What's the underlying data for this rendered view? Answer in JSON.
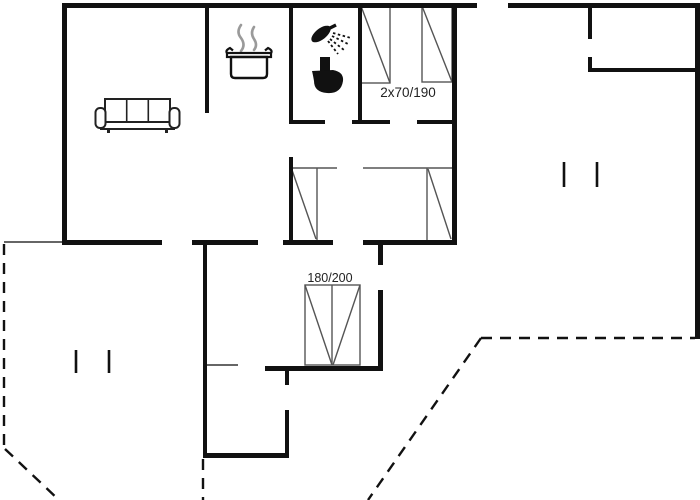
{
  "plan": {
    "title": "holiday-home-floor-plan",
    "colors": {
      "background": "#ffffff",
      "wall": "#111111",
      "thin_line": "#333333",
      "furniture_line": "#555555",
      "steam": "#9a9a9a",
      "text": "#222222"
    },
    "labels": [
      {
        "name": "bed-size-label-top",
        "text": "2x70/190",
        "x": 408,
        "y": 97,
        "size": 13.5
      },
      {
        "name": "bed-size-label-double",
        "text": "180/200",
        "x": 330,
        "y": 282,
        "size": 12.5
      }
    ],
    "walls": [
      {
        "name": "exterior-top-wall-left",
        "rect": [
          62,
          3,
          415,
          5
        ]
      },
      {
        "name": "exterior-top-wall-right",
        "rect": [
          508,
          3,
          192,
          5
        ]
      },
      {
        "name": "exterior-left-wall",
        "rect": [
          62,
          3,
          5,
          242
        ]
      },
      {
        "name": "exterior-right-wall",
        "rect": [
          695,
          3,
          5,
          336
        ]
      },
      {
        "name": "annex-wall-upper",
        "rect": [
          588,
          3,
          4,
          36
        ]
      },
      {
        "name": "annex-wall-lower",
        "rect": [
          588,
          57,
          4,
          15
        ]
      },
      {
        "name": "annex-bottom-wall",
        "rect": [
          588,
          68,
          112,
          4
        ]
      },
      {
        "name": "kitchen-partition-wall",
        "rect": [
          205,
          3,
          4,
          110
        ]
      },
      {
        "name": "bathroom-left-wall",
        "rect": [
          289,
          3,
          4,
          119
        ]
      },
      {
        "name": "bathroom-right-wall",
        "rect": [
          358,
          3,
          4,
          119
        ]
      },
      {
        "name": "bedroom1-right-wall",
        "rect": [
          452,
          3,
          5,
          242
        ]
      },
      {
        "name": "bathroom-bottom-wall",
        "rect": [
          289,
          120,
          36,
          4
        ]
      },
      {
        "name": "bedroom1-bottom-wall-left",
        "rect": [
          352,
          120,
          38,
          4
        ]
      },
      {
        "name": "bedroom1-bottom-wall-right",
        "rect": [
          417,
          120,
          35,
          4
        ]
      },
      {
        "name": "south-wall-a",
        "rect": [
          62,
          240,
          100,
          5
        ]
      },
      {
        "name": "south-wall-b",
        "rect": [
          192,
          240,
          66,
          5
        ]
      },
      {
        "name": "south-wall-c",
        "rect": [
          283,
          240,
          50,
          5
        ]
      },
      {
        "name": "south-wall-d",
        "rect": [
          363,
          240,
          94,
          5
        ]
      },
      {
        "name": "hallway-left-wall",
        "rect": [
          203,
          240,
          4,
          218
        ]
      },
      {
        "name": "bottom-room-bottom-wall",
        "rect": [
          203,
          453,
          86,
          5
        ]
      },
      {
        "name": "bottom-room-right-wall",
        "rect": [
          285,
          410,
          4,
          47
        ]
      },
      {
        "name": "bottom-room-right-stub",
        "rect": [
          285,
          366,
          4,
          19
        ]
      },
      {
        "name": "double-bedroom-bottom-wall",
        "rect": [
          265,
          366,
          118,
          5
        ]
      },
      {
        "name": "double-bedroom-right-wall",
        "rect": [
          378,
          290,
          5,
          80
        ]
      },
      {
        "name": "double-bedroom-right-stub",
        "rect": [
          378,
          245,
          5,
          20
        ]
      },
      {
        "name": "alcove-left-wall",
        "rect": [
          289,
          157,
          4,
          87
        ]
      }
    ],
    "thin_lines": [
      {
        "name": "terrace-edge-line",
        "line": [
          4,
          242,
          62,
          242
        ]
      },
      {
        "name": "closet-front-line",
        "line": [
          205,
          365,
          238,
          365
        ]
      }
    ],
    "dashed_lines": [
      {
        "name": "terrace-boundary-west",
        "line": [
          4,
          244,
          4,
          448
        ]
      },
      {
        "name": "terrace-boundary-southwest-diagonal",
        "line": [
          5,
          449,
          59,
          500
        ]
      },
      {
        "name": "terrace-boundary-south",
        "line": [
          203,
          459,
          203,
          500
        ]
      },
      {
        "name": "terrace-boundary-east-horizontal",
        "line": [
          481,
          338,
          695,
          338
        ]
      },
      {
        "name": "terrace-boundary-east-diagonal",
        "line": [
          481,
          338,
          368,
          500
        ]
      }
    ],
    "window_ticks": [
      {
        "name": "window-tick",
        "line": [
          76,
          350,
          76,
          373
        ]
      },
      {
        "name": "window-tick",
        "line": [
          109,
          350,
          109,
          373
        ]
      },
      {
        "name": "window-tick",
        "line": [
          564,
          162,
          564,
          187
        ]
      },
      {
        "name": "window-tick",
        "line": [
          597,
          162,
          597,
          187
        ]
      }
    ],
    "beds": [
      {
        "name": "single-bed-1",
        "rect": [
          361,
          6,
          29,
          77
        ],
        "lines": [
          [
            361,
            6,
            390,
            83
          ]
        ]
      },
      {
        "name": "single-bed-2",
        "rect": [
          422,
          6,
          30,
          76
        ],
        "lines": [
          [
            422,
            6,
            452,
            82
          ]
        ]
      },
      {
        "name": "alcove-bed-left",
        "lines": [
          [
            291,
            168,
            337,
            168
          ],
          [
            317,
            168,
            317,
            240
          ],
          [
            292,
            170,
            316,
            239
          ]
        ]
      },
      {
        "name": "alcove-bed-right",
        "lines": [
          [
            363,
            168,
            452,
            168
          ],
          [
            427,
            168,
            427,
            240
          ],
          [
            428,
            169,
            451,
            239
          ]
        ]
      },
      {
        "name": "double-bed-180x200",
        "rect": [
          305,
          285,
          55,
          80
        ],
        "lines": [
          [
            332,
            285,
            332,
            365
          ],
          [
            305,
            285,
            332,
            365
          ],
          [
            360,
            285,
            333,
            365
          ]
        ]
      }
    ],
    "icons": [
      {
        "name": "sofa-icon",
        "x": 95,
        "y": 97
      },
      {
        "name": "cooking-pot-icon",
        "x": 226,
        "y": 23
      },
      {
        "name": "shower-icon",
        "x": 310,
        "y": 25
      },
      {
        "name": "toilet-icon",
        "x": 310,
        "y": 56
      }
    ]
  }
}
